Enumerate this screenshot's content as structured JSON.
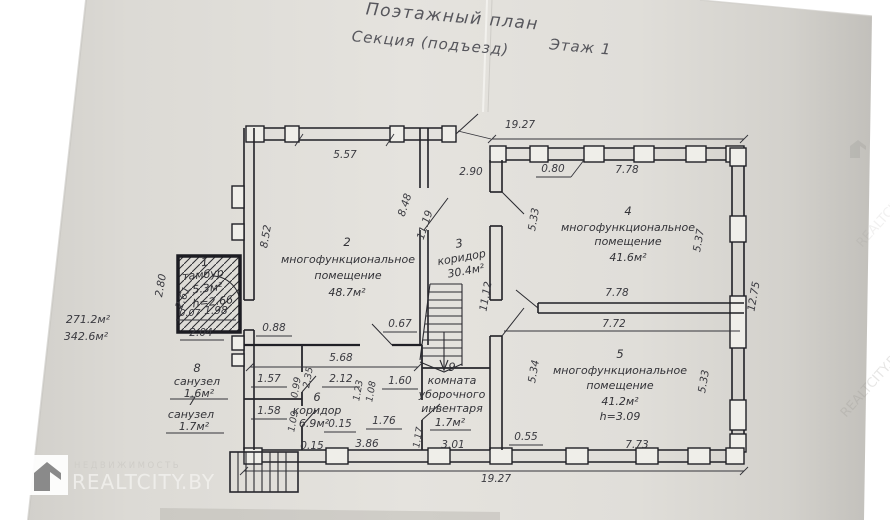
{
  "title": {
    "line1": "Поэтажный план",
    "line2a": "Секция (подъезд)",
    "line2b": "Этаж 1"
  },
  "rooms": {
    "r1": {
      "num": "1",
      "name": "тамбур",
      "area": "5.3м²",
      "height": "h=2.66"
    },
    "r2": {
      "num": "2",
      "name1": "многофункциональное",
      "name2": "помещение",
      "area": "48.7м²"
    },
    "r3": {
      "num": "3",
      "name": "коридор",
      "area": "30.4м²"
    },
    "r4": {
      "num": "4",
      "name1": "многофункциональное",
      "name2": "помещение",
      "area": "41.6м²"
    },
    "r5": {
      "num": "5",
      "name1": "многофункциональное",
      "name2": "помещение",
      "area": "41.2м²",
      "height": "h=3.09"
    },
    "r6": {
      "num": "6",
      "name": "коридор",
      "area": "6.9м²"
    },
    "r7": {
      "num": "7",
      "name": "санузел",
      "area": "1.7м²"
    },
    "r8": {
      "num": "8",
      "name": "санузел",
      "area": "1.6м²"
    },
    "r9": {
      "num": "9",
      "name1": "комната",
      "name2": "уборочного",
      "name3": "инвентаря",
      "area": "1.7м²"
    }
  },
  "totals": {
    "total1": "271.2м²",
    "total2": "342.6м²"
  },
  "dims": {
    "d1927": "19.27",
    "d557": "5.57",
    "d290": "2.90",
    "d080": "0.80",
    "d778": "7.78",
    "d848": "8.48",
    "d1119": "11.19",
    "d533": "5.33",
    "d537": "5.37",
    "d1275": "12.75",
    "d852": "8.52",
    "d280": "2.80",
    "d261": "2.61",
    "d007": "0.07",
    "d198": "1.98",
    "d204": "2.04",
    "d088": "0.88",
    "d067": "0.67",
    "d568": "5.68",
    "d1112": "11.12",
    "d772": "7.72",
    "d534": "5.34",
    "d157": "1.57",
    "d099": "0.99",
    "d235": "2.35",
    "d212": "2.12",
    "d123": "1.23",
    "d108": "1.08",
    "d160": "1.60",
    "d158": "1.58",
    "d109": "1.09",
    "d015": "0.15",
    "d176": "1.76",
    "d117": "1.17",
    "d386": "3.86",
    "d301": "3.01",
    "d055": "0.55",
    "d773": "7.73"
  },
  "watermark": {
    "caption": "НЕДВИЖИМОСТЬ",
    "brand": "REALTCITY.BY"
  }
}
